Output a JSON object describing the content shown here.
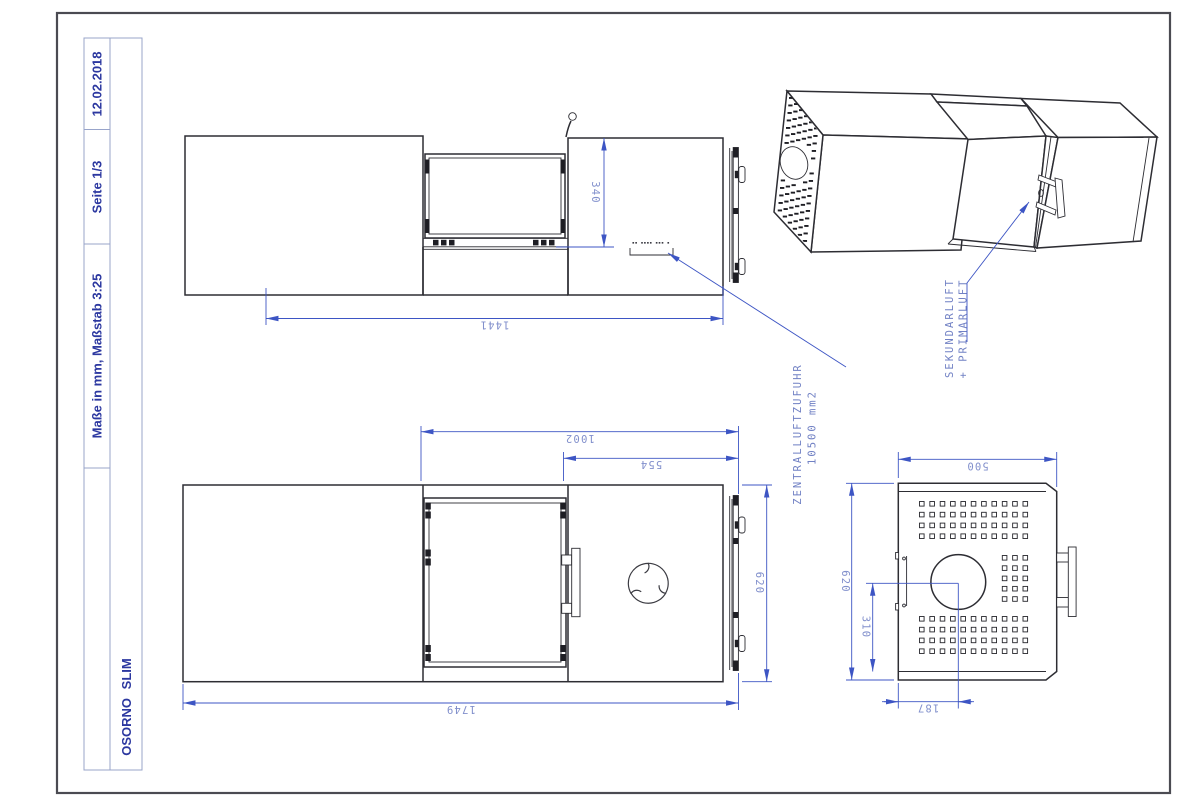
{
  "title_block": {
    "date": "12.02.2018",
    "page": "Seite 1/3",
    "scale_note": "Maße in mm, Maßstab 3:25",
    "product_name": "OSORNO SLIM"
  },
  "annotations": {
    "central_air": {
      "line1": "ZENTRALLUFTZUFUHR",
      "line2": "10500 mm2"
    },
    "combustion_air": {
      "line1": "SEKUNDARLUFT",
      "line2": "+ PRIMARLUFT"
    },
    "micro_note": "▪▪ ▪▪▪▪ ▪▪▪ ▪"
  },
  "views": {
    "top": {
      "dim_length": "1441",
      "dim_height": "340"
    },
    "front": {
      "dim_overall": "1749",
      "dim_right_section": "1002",
      "dim_door_section": "554",
      "dim_height": "620"
    },
    "end": {
      "dim_width": "500",
      "dim_height": "620",
      "dim_center_height": "310",
      "dim_center_offset": "187"
    }
  },
  "colors": {
    "dimension_blue": "#3d55c4",
    "dimension_text_blue": "#8290cc",
    "title_navy": "#2c38a0",
    "geometry_dark": "#2d2d33"
  }
}
